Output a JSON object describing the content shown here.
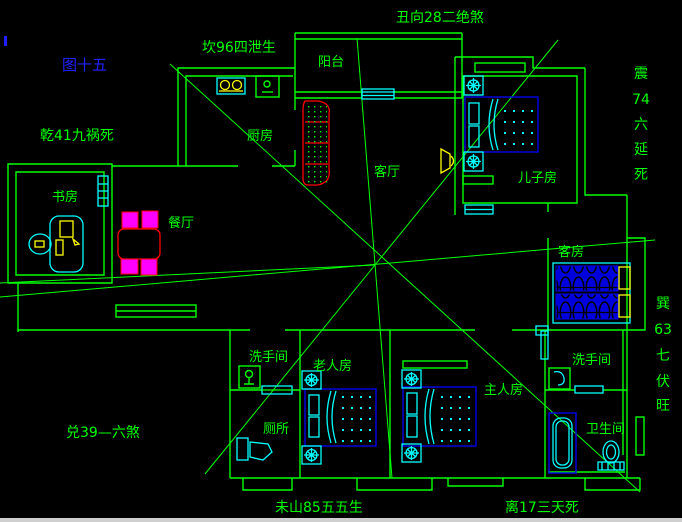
{
  "figure": {
    "label": "图十五"
  },
  "annotations": {
    "top_center": {
      "text": "丑向28二绝煞"
    },
    "top_left": {
      "text": "坎96四泄生"
    },
    "left": {
      "text": "乾41九祸死"
    },
    "right_upper": {
      "chars": [
        "震",
        "74",
        "六",
        "延",
        "死"
      ]
    },
    "right_lower": {
      "chars": [
        "巽",
        "63",
        "七",
        "伏",
        "旺"
      ]
    },
    "bottom_left": {
      "text": "兑39—六煞"
    },
    "bottom_center": {
      "text": "未山85五五生"
    },
    "bottom_right": {
      "text": "离17三天死"
    }
  },
  "rooms": {
    "balcony": "阳台",
    "kitchen": "厨房",
    "study": "书房",
    "dining": "餐厅",
    "living": "客厅",
    "son_room": "儿子房",
    "guest_room": "客房",
    "washroom_left": "洗手间",
    "toilet": "厕所",
    "elder_room": "老人房",
    "master_room": "主人房",
    "washroom_right": "洗手间",
    "bathroom": "卫生间"
  },
  "colors": {
    "background": "#000000",
    "wall_and_labels": "#00ff00",
    "figure_label": "#2020ff",
    "furniture_trim": "#00ffff",
    "beds": "#0000ee",
    "sofa_table": "#ff0000",
    "chairs": "#ff00ff",
    "appliances": "#ffff00"
  }
}
